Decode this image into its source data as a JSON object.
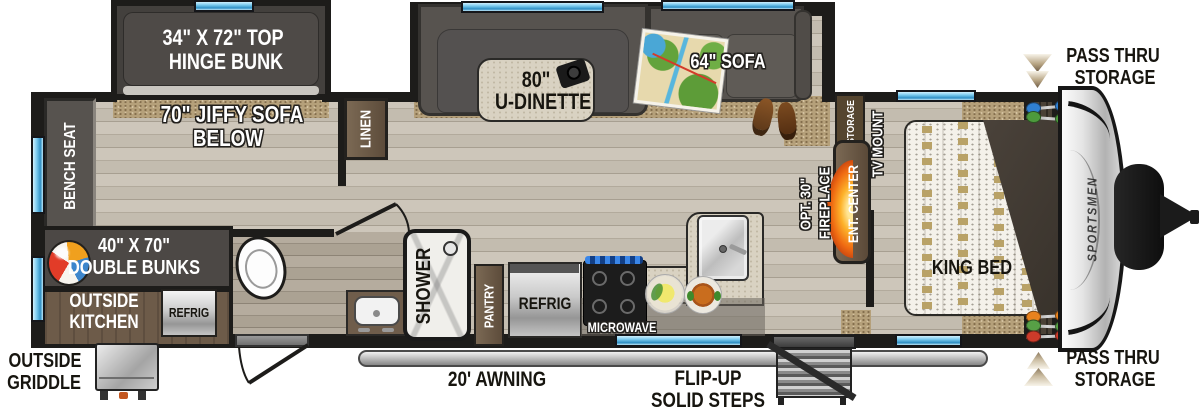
{
  "floorplan": {
    "brand": "SPORTSMEN",
    "slide_bunk": {
      "line1": "34\" X 72\" TOP",
      "line2": "HINGE BUNK"
    },
    "jiffy_sofa": {
      "line1": "70\" JIFFY SOFA",
      "line2": "BELOW"
    },
    "bench_seat": "BENCH SEAT",
    "linen": "LINEN",
    "dinette": {
      "line1": "80\"",
      "line2": "U-DINETTE"
    },
    "sofa": "64\" SOFA",
    "pass_thru_top": {
      "line1": "PASS THRU",
      "line2": "STORAGE"
    },
    "pass_thru_bottom": {
      "line1": "PASS THRU",
      "line2": "STORAGE"
    },
    "fireplace": {
      "line1": "OPT. 30\"",
      "line2": "FIREPLACE"
    },
    "ent_center": "ENT. CENTER",
    "storage": "STORAGE",
    "tv_mount": "TV MOUNT",
    "king_bed": "KING BED",
    "double_bunks": {
      "line1": "40\" X 70\"",
      "line2": "DOUBLE BUNKS"
    },
    "outside_kitchen": {
      "line1": "OUTSIDE",
      "line2": "KITCHEN",
      "refrig": "REFRIG"
    },
    "outside_griddle": {
      "line1": "OUTSIDE",
      "line2": "GRIDDLE"
    },
    "bathroom": {
      "shower": "SHOWER"
    },
    "kitchen": {
      "pantry": "PANTRY",
      "refrig": "REFRIG",
      "microwave": "MICROWAVE"
    },
    "exterior": {
      "awning": "20' AWNING",
      "steps_line1": "FLIP-UP",
      "steps_line2": "SOLID STEPS"
    },
    "colors": {
      "wall": "#1d1c1a",
      "window_blue": "#7fcdf0",
      "wood_floor": "#c6bfb3",
      "carpet_tan": "#b5a07a",
      "cabinet_brown": "#6d5b49",
      "furniture_dark": "#57534f",
      "fireplace_orange": "#f07818",
      "awning_gray": "#c8c8c8"
    }
  }
}
